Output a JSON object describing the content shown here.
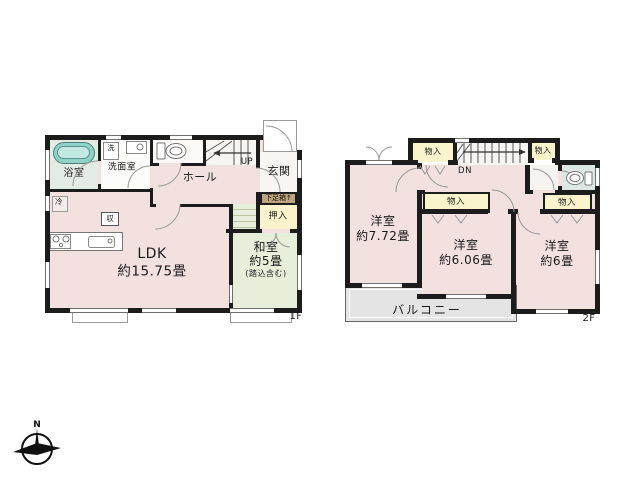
{
  "colors": {
    "wall": "#1c1c1c",
    "room_pink": "#f2e1df",
    "tatami_green": "#e7eeda",
    "bath_green": "#e3ebe5",
    "closet_yellow": "#faf4cc",
    "shoe_cabinet_tan": "#bba47e",
    "balcony_gray": "#e4e4e4",
    "bathtub_teal": "#8fd2c6"
  },
  "floor1": {
    "floor_tag": "1F",
    "bath": "浴室",
    "washroom": "洗面室",
    "washer": "洗",
    "hall": "ホール",
    "stairs_up": "UP",
    "entrance": "玄関",
    "shoe_cabinet": "下足箱↑",
    "closet": "押入",
    "ldk_name": "LDK",
    "ldk_size": "約15.75畳",
    "washitsu_name": "和室",
    "washitsu_size": "約5畳",
    "washitsu_note": "(踏込含む)",
    "fridge": "冷",
    "storage": "収"
  },
  "floor2": {
    "floor_tag": "2F",
    "closet_top_left": "物入",
    "closet_top_right": "物入",
    "closet_mid": "物入",
    "closet_right": "物入",
    "stairs_down": "DN",
    "room1_name": "洋室",
    "room1_size": "約7.72畳",
    "room2_name": "洋室",
    "room2_size": "約6.06畳",
    "room3_name": "洋室",
    "room3_size": "約6畳",
    "balcony": "バルコニー"
  },
  "compass": {
    "north": "N"
  }
}
